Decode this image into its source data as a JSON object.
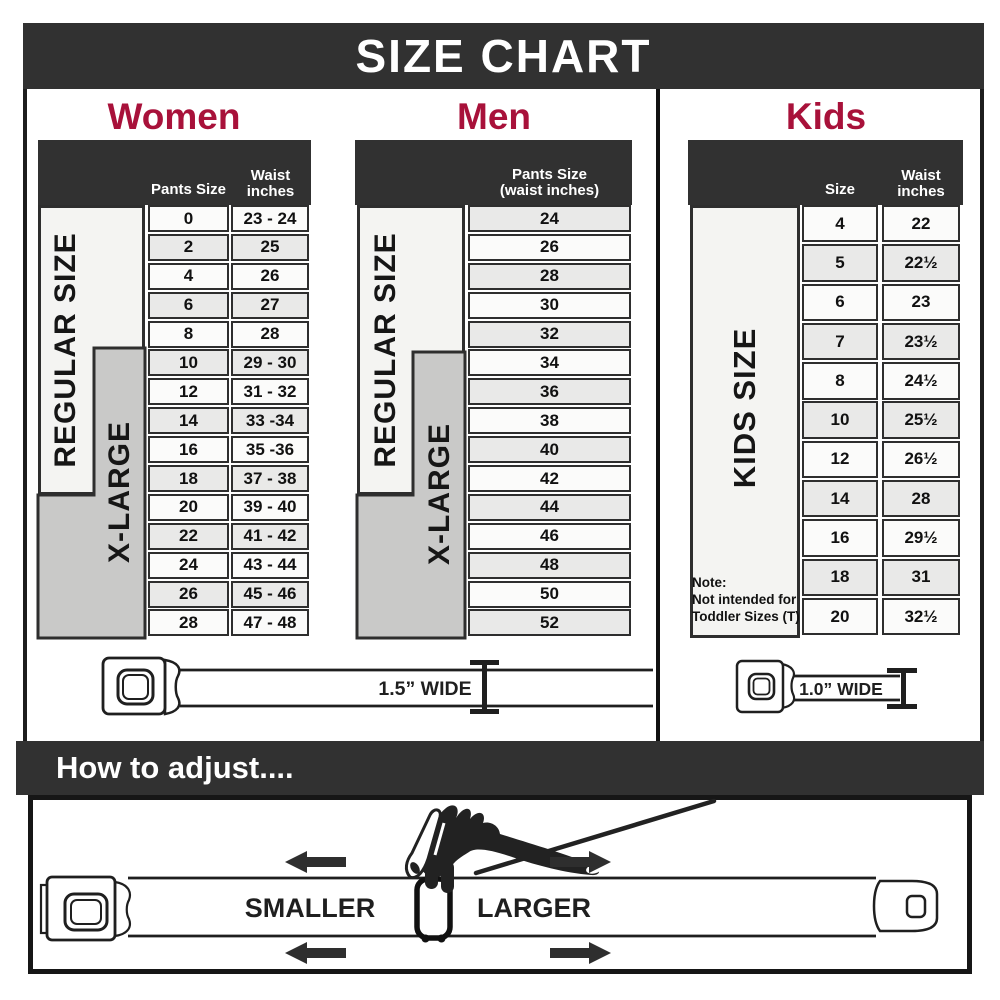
{
  "title": "SIZE CHART",
  "adjust": {
    "heading": "How to adjust....",
    "smaller": "SMALLER",
    "larger": "LARGER"
  },
  "belts": {
    "adult_width_label": "1.5” WIDE",
    "kids_width_label": "1.0” WIDE"
  },
  "sections": {
    "women": {
      "title": "Women",
      "col1_header": "Pants Size",
      "col2_header_line1": "Waist",
      "col2_header_line2": "inches",
      "regular_label": "REGULAR SIZE",
      "xlarge_label": "X-LARGE",
      "rows": [
        {
          "size": "0",
          "waist": "23 - 24"
        },
        {
          "size": "2",
          "waist": "25"
        },
        {
          "size": "4",
          "waist": "26"
        },
        {
          "size": "6",
          "waist": "27"
        },
        {
          "size": "8",
          "waist": "28"
        },
        {
          "size": "10",
          "waist": "29 - 30"
        },
        {
          "size": "12",
          "waist": "31 - 32"
        },
        {
          "size": "14",
          "waist": "33 -34"
        },
        {
          "size": "16",
          "waist": "35 -36"
        },
        {
          "size": "18",
          "waist": "37 - 38"
        },
        {
          "size": "20",
          "waist": "39 - 40"
        },
        {
          "size": "22",
          "waist": "41 - 42"
        },
        {
          "size": "24",
          "waist": "43 - 44"
        },
        {
          "size": "26",
          "waist": "45 - 46"
        },
        {
          "size": "28",
          "waist": "47 - 48"
        }
      ]
    },
    "men": {
      "title": "Men",
      "col_header_line1": "Pants Size",
      "col_header_line2": "(waist inches)",
      "regular_label": "REGULAR SIZE",
      "xlarge_label": "X-LARGE",
      "rows": [
        "24",
        "26",
        "28",
        "30",
        "32",
        "34",
        "36",
        "38",
        "40",
        "42",
        "44",
        "46",
        "48",
        "50",
        "52"
      ]
    },
    "kids": {
      "title": "Kids",
      "col1_header": "Size",
      "col2_header_line1": "Waist",
      "col2_header_line2": "inches",
      "label": "KIDS SIZE",
      "note_lines": [
        "Note:",
        "Not intended for",
        "Toddler Sizes (T)"
      ],
      "rows": [
        {
          "size": "4",
          "waist": "22"
        },
        {
          "size": "5",
          "waist": "22½"
        },
        {
          "size": "6",
          "waist": "23"
        },
        {
          "size": "7",
          "waist": "23½"
        },
        {
          "size": "8",
          "waist": "24½"
        },
        {
          "size": "10",
          "waist": "25½"
        },
        {
          "size": "12",
          "waist": "26½"
        },
        {
          "size": "14",
          "waist": "28"
        },
        {
          "size": "16",
          "waist": "29½"
        },
        {
          "size": "18",
          "waist": "31"
        },
        {
          "size": "20",
          "waist": "32½"
        }
      ]
    }
  },
  "colors": {
    "bar_dark": "#313131",
    "accent_red": "#A8113A",
    "row_light": "#fbfbfa",
    "row_gray": "#e9e9e8",
    "label_light": "#f4f4f2",
    "label_gray": "#c9c9c8",
    "border_dark": "#2e2e2e"
  }
}
